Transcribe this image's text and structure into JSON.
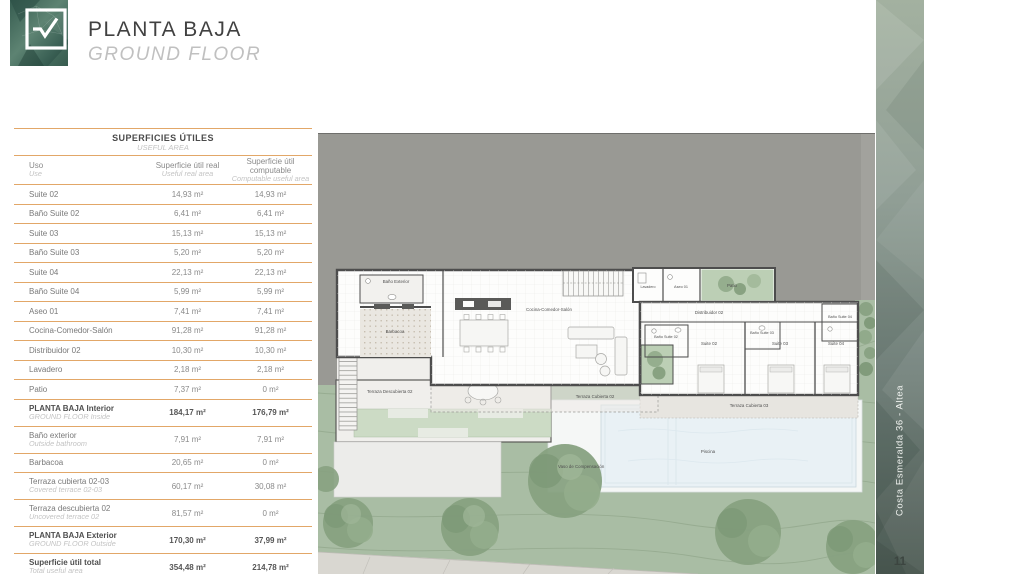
{
  "header": {
    "title": "PLANTA BAJA",
    "subtitle": "GROUND FLOOR"
  },
  "table": {
    "title": "SUPERFICIES ÚTILES",
    "subtitle": "USEFUL AREA",
    "columns": [
      {
        "es": "Uso",
        "en": "Use"
      },
      {
        "es": "Superficie útil real",
        "en": "Useful real area"
      },
      {
        "es": "Superficie útil computable",
        "en": "Computable useful area"
      }
    ],
    "rows": [
      {
        "uso": "Suite 02",
        "real": "14,93 m²",
        "comp": "14,93 m²"
      },
      {
        "uso": "Baño Suite 02",
        "real": "6,41 m²",
        "comp": "6,41 m²"
      },
      {
        "uso": "Suite 03",
        "real": "15,13 m²",
        "comp": "15,13 m²"
      },
      {
        "uso": "Baño Suite 03",
        "real": "5,20 m²",
        "comp": "5,20 m²"
      },
      {
        "uso": "Suite 04",
        "real": "22,13 m²",
        "comp": "22,13 m²"
      },
      {
        "uso": "Baño Suite 04",
        "real": "5,99 m²",
        "comp": "5,99 m²"
      },
      {
        "uso": "Aseo 01",
        "real": "7,41 m²",
        "comp": "7,41 m²"
      },
      {
        "uso": "Cocina-Comedor-Salón",
        "real": "91,28 m²",
        "comp": "91,28 m²"
      },
      {
        "uso": "Distribuidor 02",
        "real": "10,30 m²",
        "comp": "10,30 m²"
      },
      {
        "uso": "Lavadero",
        "real": "2,18 m²",
        "comp": "2,18 m²"
      },
      {
        "uso": "Patio",
        "real": "7,37 m²",
        "comp": "0 m²"
      },
      {
        "uso": "PLANTA BAJA Interior",
        "uso_en": "GROUND FLOOR Inside",
        "real": "184,17 m²",
        "comp": "176,79 m²"
      },
      {
        "uso": "Baño exterior",
        "uso_en": "Outside bathroom",
        "real": "7,91 m²",
        "comp": "7,91 m²"
      },
      {
        "uso": "Barbacoa",
        "real": "20,65 m²",
        "comp": "0 m²"
      },
      {
        "uso": "Terraza cubierta 02-03",
        "uso_en": "Covered terrace 02-03",
        "real": "60,17 m²",
        "comp": "30,08 m²"
      },
      {
        "uso": "Terraza descubierta 02",
        "uso_en": "Uncovered terrace 02",
        "real": "81,57 m²",
        "comp": "0 m²"
      },
      {
        "uso": "PLANTA BAJA Exterior",
        "uso_en": "GROUND FLOOR Outside",
        "real": "170,30 m²",
        "comp": "37,99 m²"
      },
      {
        "uso": "Superficie útil total",
        "uso_en": "Total useful area",
        "real": "354,48 m²",
        "comp": "214,78 m²"
      }
    ]
  },
  "plan": {
    "labels": {
      "bano_exterior": "Baño Exterior",
      "barbacoa": "Barbacoa",
      "cocina": "Cocina-Comedor-Salón",
      "lavadero": "Lavadero",
      "aseo": "Aseo 01",
      "patio": "Patio",
      "distribuidor": "Distribuidor 02",
      "bano_suite_02": "Baño Suite 02",
      "bano_suite_03": "Baño Suite 03",
      "bano_suite_04": "Baño Suite 04",
      "suite_02": "Suite 02",
      "suite_03": "Suite 03",
      "suite_04": "Suite 04",
      "terraza_descubierta_02": "Terraza Descubierta 02",
      "terraza_cubierta_02": "Terraza Cubierta 02",
      "terraza_cubierta_03": "Terraza Cubierta 03",
      "piscina": "Piscina",
      "vaso": "Vaso de Compensación"
    }
  },
  "sidebar": {
    "project": "Costa Esmeralda 36 - Altea",
    "page": "11"
  },
  "colors": {
    "accent_line": "#e2a768",
    "ground_gray": "#999994",
    "lawn_green": "#a9bda4",
    "wall_dark": "#4d4d4d",
    "brand_green": "#2e5248"
  }
}
